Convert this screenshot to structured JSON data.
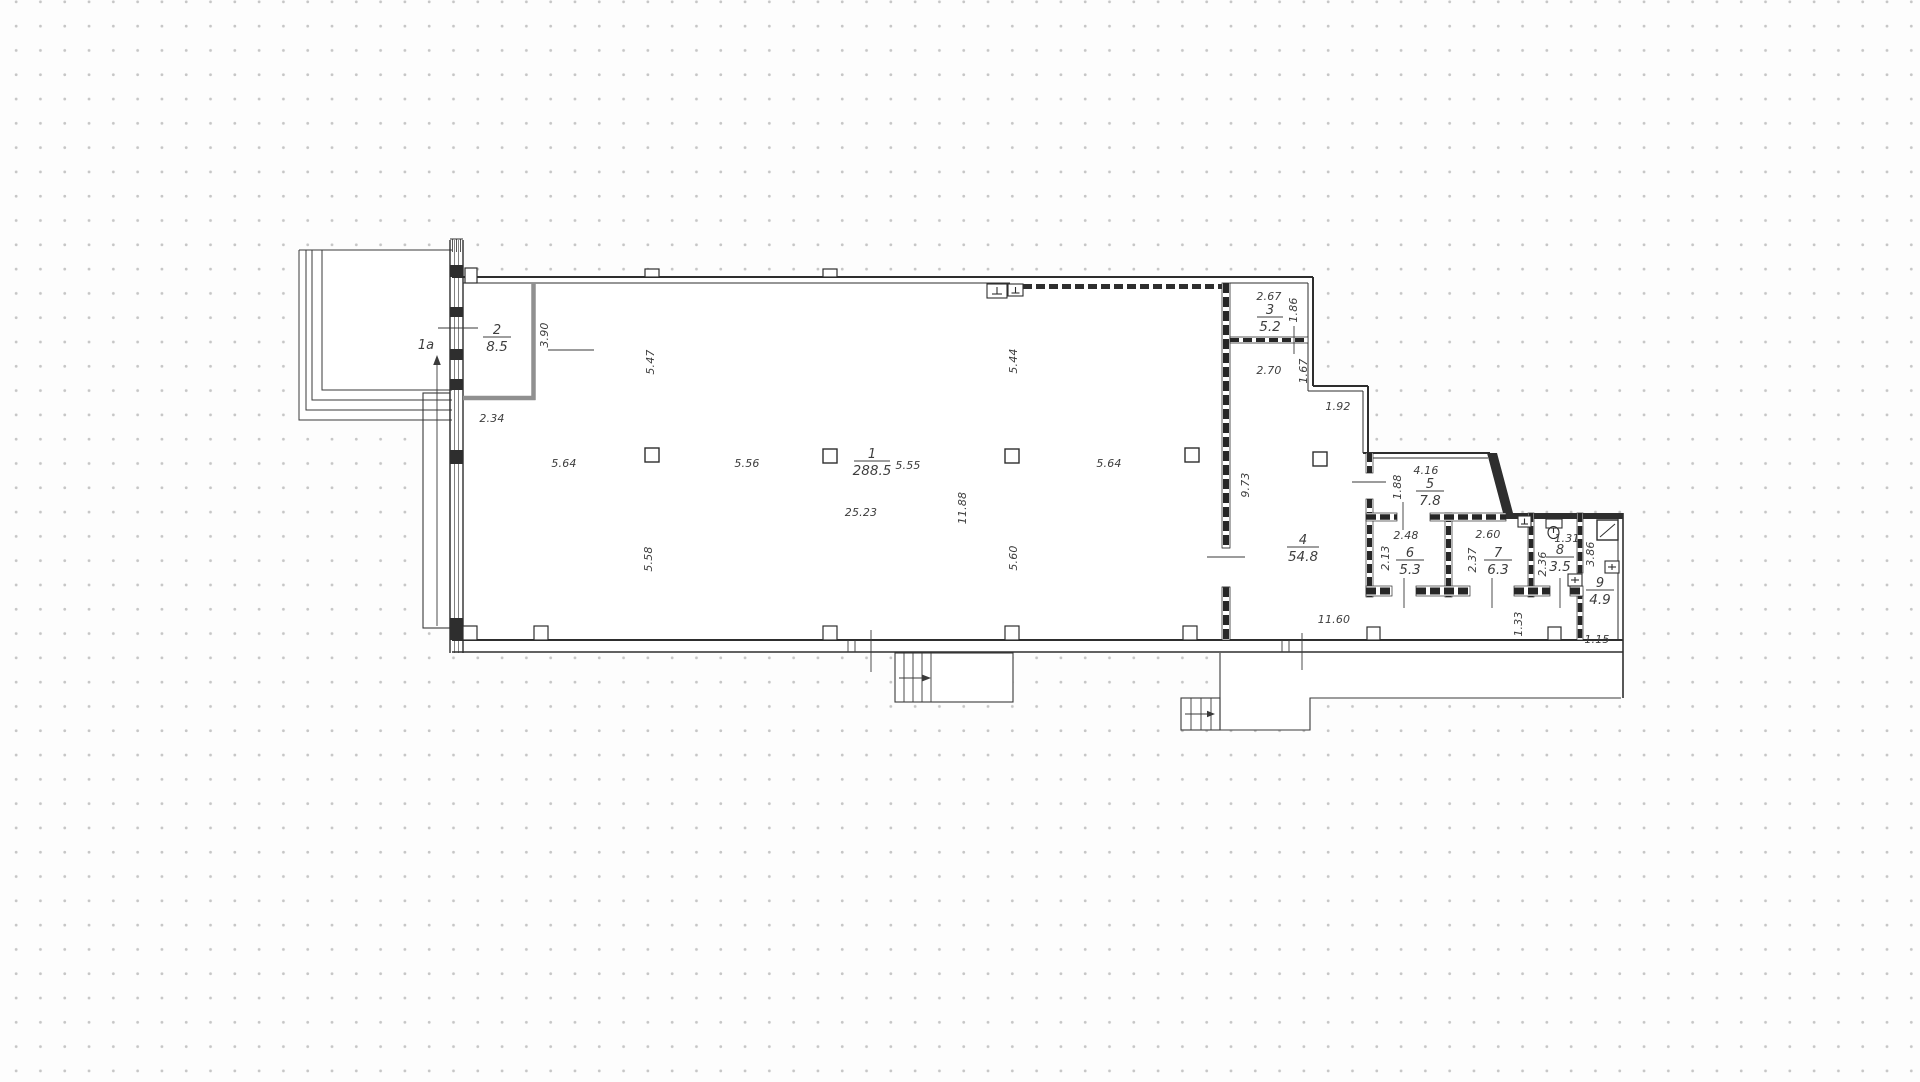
{
  "plan": {
    "zone_label": "1a",
    "rooms": {
      "r1": {
        "number": "1",
        "area": "288.5"
      },
      "r2": {
        "number": "2",
        "area": "8.5"
      },
      "r3": {
        "number": "3",
        "area": "5.2"
      },
      "r4": {
        "number": "4",
        "area": "54.8"
      },
      "r5": {
        "number": "5",
        "area": "7.8"
      },
      "r6": {
        "number": "6",
        "area": "5.3"
      },
      "r7": {
        "number": "7",
        "area": "6.3"
      },
      "r8": {
        "number": "8",
        "area": "3.5"
      },
      "r9": {
        "number": "9",
        "area": "4.9"
      }
    },
    "dims": {
      "bay_top_1": "5.64",
      "bay_top_2": "5.56",
      "bay_top_3": "5.55",
      "bay_top_4": "5.64",
      "hall_length": "25.23",
      "hall_depth": "11.88",
      "col_top_1": "5.47",
      "col_top_2": "5.44",
      "col_bot_1": "5.58",
      "col_bot_2": "5.60",
      "room2_w": "2.34",
      "room2_h": "3.90",
      "room3_w": "2.67",
      "room3_h": "1.86",
      "vest_w": "2.70",
      "vest_h": "1.67",
      "step_w": "1.92",
      "room4_h": "9.73",
      "room5_w": "4.16",
      "room5_h": "1.88",
      "room6_w": "2.48",
      "room6_h": "2.13",
      "room7_w": "2.60",
      "room7_h": "2.37",
      "room8_w": "1.31",
      "room8_h": "2.36",
      "room9_h": "3.86",
      "room9_w": "1.15",
      "corridor_len": "11.60",
      "corridor_w": "1.33"
    },
    "icons": {
      "toilet": "toilet-icon",
      "shower": "shower-icon",
      "vent": "vent-duct-icon"
    },
    "colors": {
      "line": "#2e2e2e",
      "text": "#3d3d3d",
      "partition_gray": "#909090",
      "grid_dot": "#c6c6c6"
    }
  }
}
